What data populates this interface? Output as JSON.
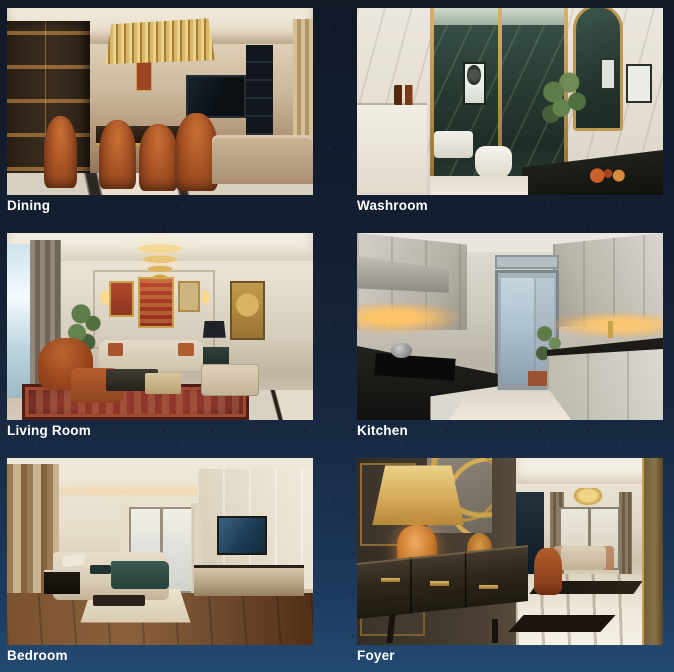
{
  "page": {
    "background_top": "#111927",
    "background_bottom": "#234a72",
    "caption_color": "#ffffff"
  },
  "gallery": {
    "items": [
      {
        "id": "dining",
        "label": "Dining",
        "alt": "Luxury dining room render with rust velvet chairs, linear gold chandelier, lit display cabinet, marble wall and TV"
      },
      {
        "id": "washroom",
        "label": "Washroom",
        "alt": "Marble washroom render with green marble shower behind gold-framed glass, plant, arched mirror and dark vanity"
      },
      {
        "id": "living-room",
        "label": "Living Room",
        "alt": "Classic living room render with tiered gold chandelier, framed art wall, cream sofas, rust armchair and red oriental rug"
      },
      {
        "id": "kitchen",
        "label": "Kitchen",
        "alt": "Galley kitchen render with light grey cabinets, dark counters, warm under-cabinet lighting and balcony door with plant"
      },
      {
        "id": "bedroom",
        "label": "Bedroom",
        "alt": "Bedroom render with wood flooring, upholstered bed with teal throw, wall-mounted TV, long dresser and balcony door"
      },
      {
        "id": "foyer",
        "label": "Foyer",
        "alt": "Foyer render with amber table lamp on dark console, gold wall decor and marble floor leading to the living area"
      }
    ]
  }
}
